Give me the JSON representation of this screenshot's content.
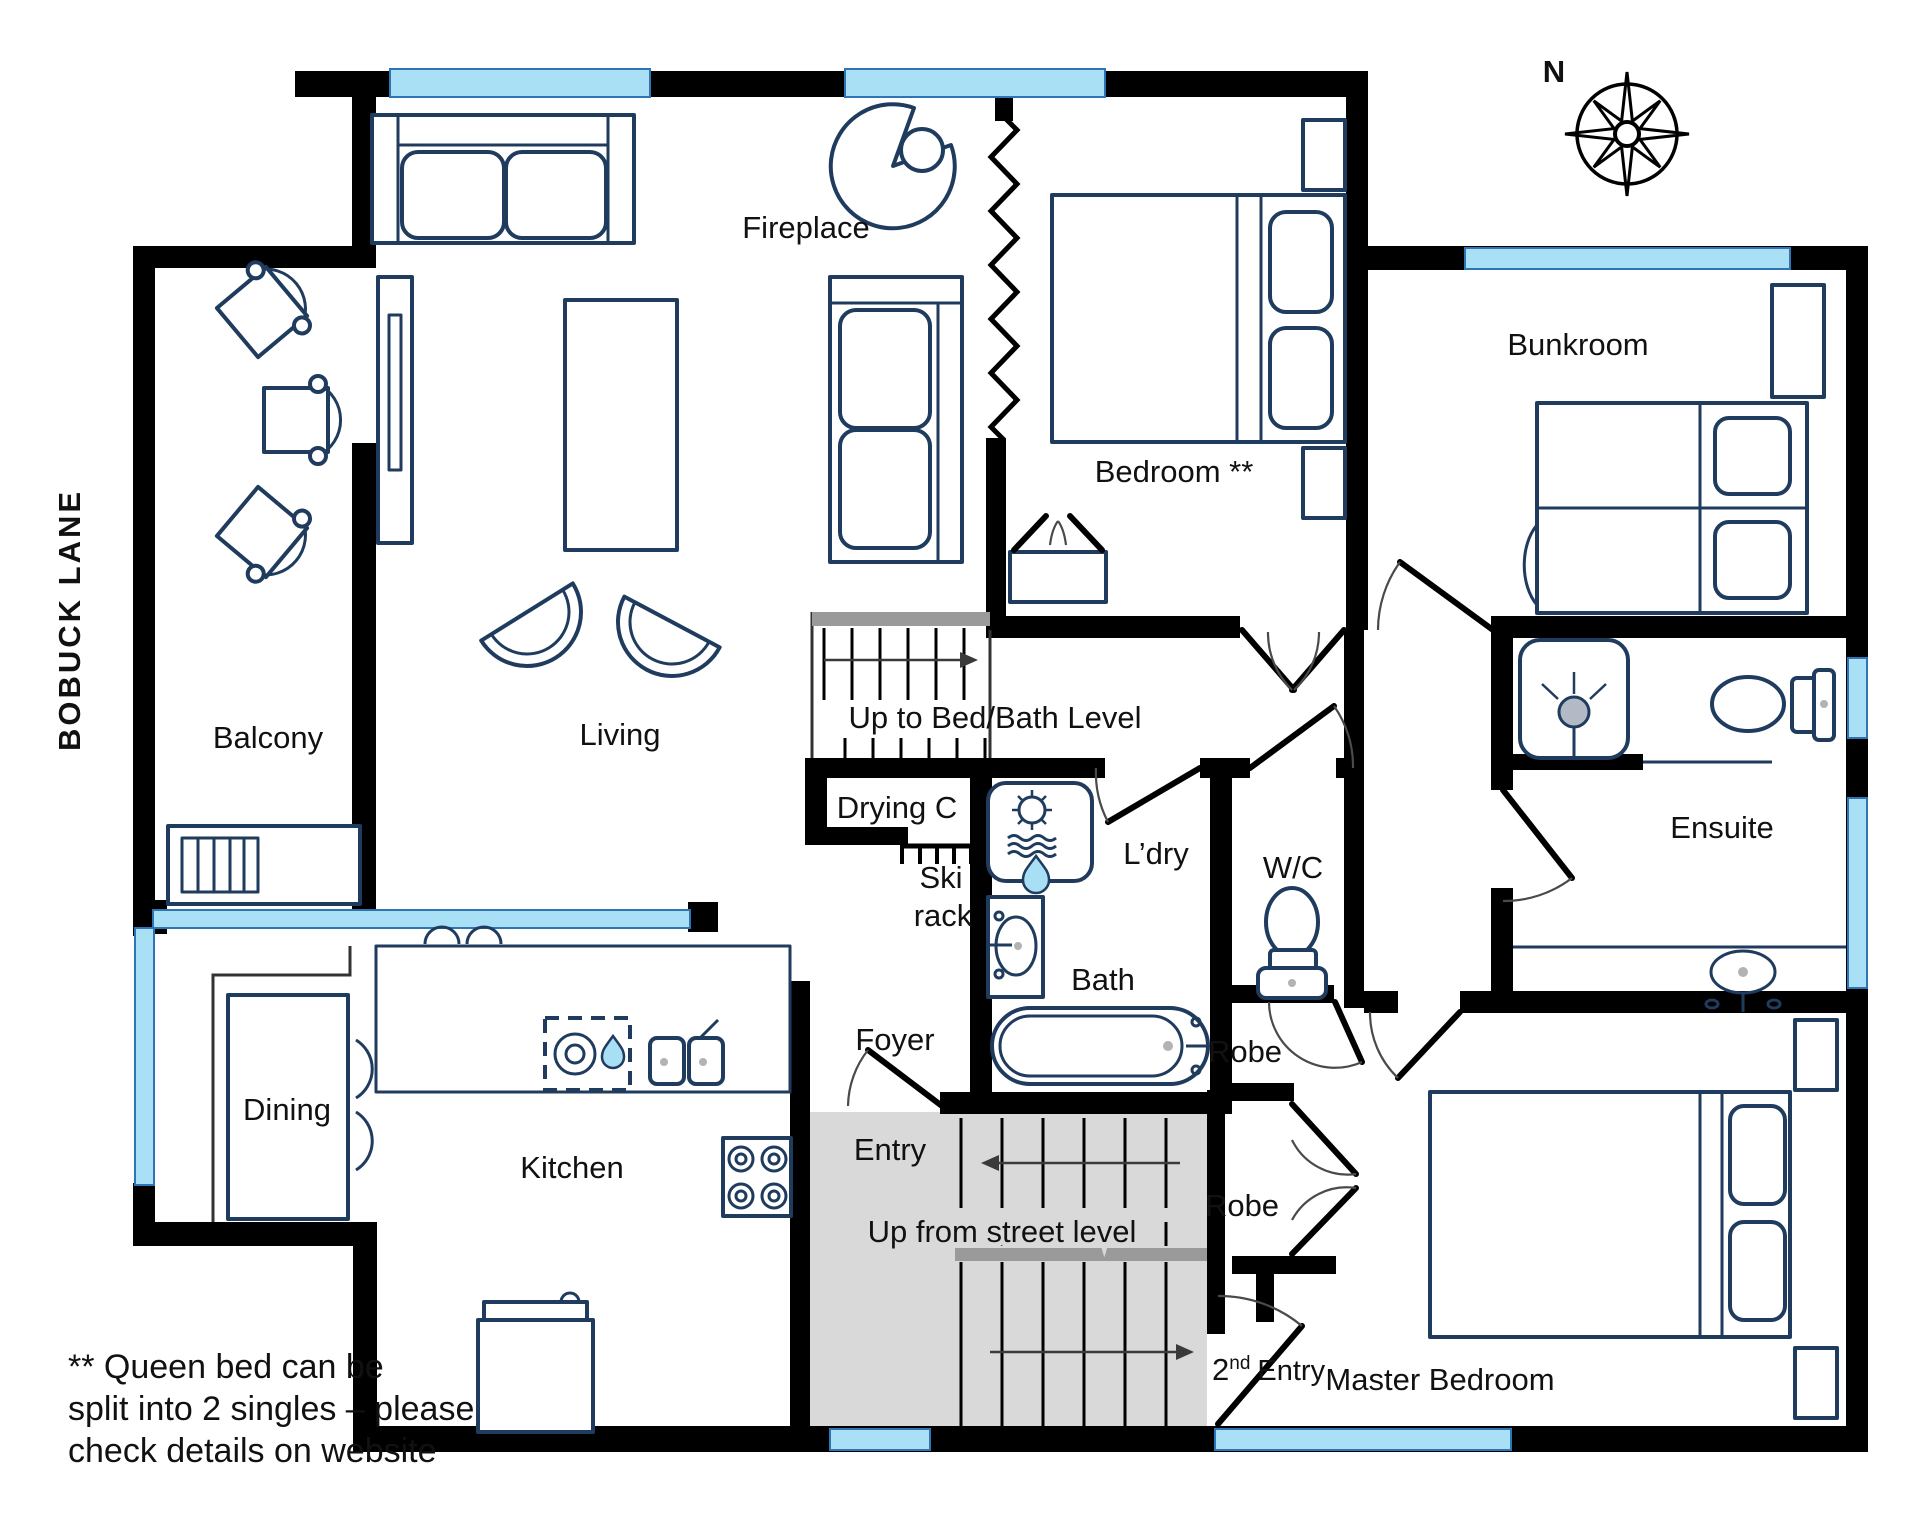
{
  "floorplan": {
    "street_label": "BOBUCK LANE",
    "compass_label": "N",
    "rooms": {
      "living": "Living",
      "balcony": "Balcony",
      "dining": "Dining",
      "kitchen": "Kitchen",
      "foyer": "Foyer",
      "entry": "Entry",
      "bedroom": "Bedroom **",
      "bunkroom": "Bunkroom",
      "ensuite": "Ensuite",
      "master_bedroom": "Master Bedroom",
      "bath": "Bath",
      "laundry": "L’dry",
      "wc": "W/C",
      "drying_cupboard": "Drying C",
      "ski_rack_line1": "Ski",
      "ski_rack_line2": "rack",
      "robe_upper": "Robe",
      "robe_lower": "Robe",
      "fireplace": "Fireplace"
    },
    "stairs": {
      "upper_label": "Up to Bed/Bath Level",
      "lower_label": "Up from street level"
    },
    "second_entry": {
      "num": "2",
      "sup": "nd",
      "rest": "Entry"
    },
    "note": {
      "line1": "**  Queen bed can be",
      "line2": "split into 2 singles – please",
      "line3": "check details on website"
    },
    "colors": {
      "wall": "#000000",
      "furniture_line": "#1f3b5e",
      "window_fill": "#a9e0f6",
      "window_edge": "#2e75b6",
      "stair_fill": "#d9d9d9",
      "landing_bar": "#9a9a9a",
      "water_accent": "#a9dff5",
      "text": "#111111"
    }
  }
}
